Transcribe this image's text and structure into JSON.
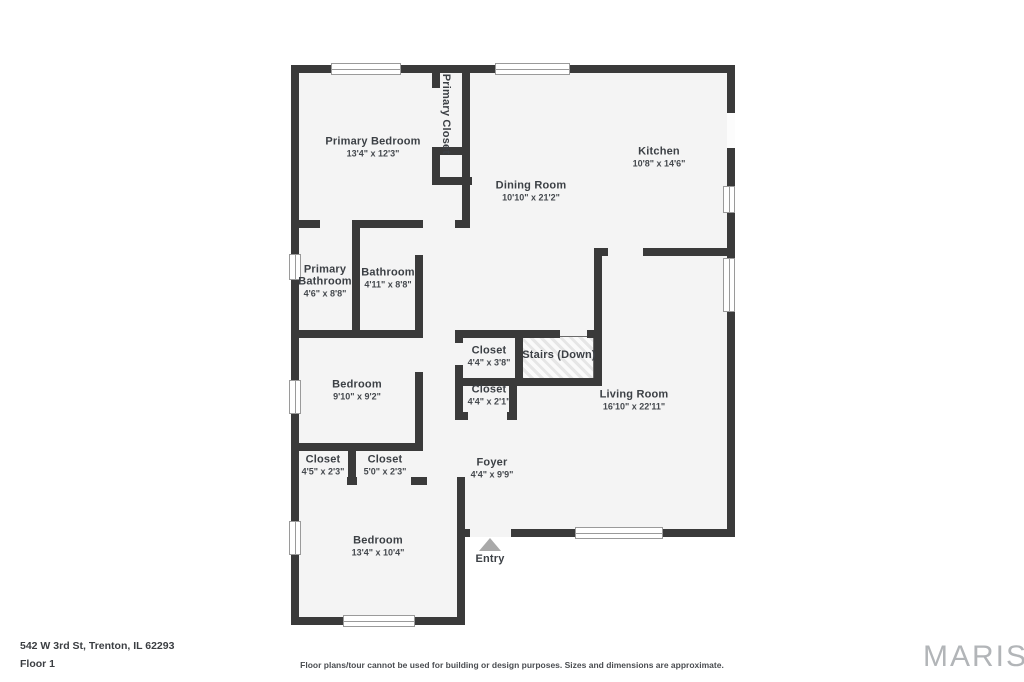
{
  "page": {
    "address": "542 W 3rd St, Trenton, IL 62293",
    "floor_label": "Floor 1",
    "disclaimer": "Floor plans/tour cannot be used for building or design purposes. Sizes and dimensions are approximate.",
    "brand": "MARIS"
  },
  "colors": {
    "wall": "#3a3a3a",
    "floor": "#f4f4f4",
    "entry_arrow": "#a9a9a9",
    "brand_gray": "#b2b5b8"
  },
  "rooms": [
    {
      "name": "Primary Bedroom",
      "dims": "13'4\" x 12'3\""
    },
    {
      "name": "Primary Closet",
      "dims": ""
    },
    {
      "name": "Kitchen",
      "dims": "10'8\" x 14'6\""
    },
    {
      "name": "Dining Room",
      "dims": "10'10\" x 21'2\""
    },
    {
      "name": "Primary Bathroom",
      "dims": "4'6\" x 8'8\""
    },
    {
      "name": "Bathroom",
      "dims": "4'11\" x 8'8\""
    },
    {
      "name": "Closet",
      "dims": "4'4\" x 3'8\""
    },
    {
      "name": "Stairs (Down)",
      "dims": ""
    },
    {
      "name": "Closet",
      "dims": "4'4\" x 2'1\""
    },
    {
      "name": "Bedroom",
      "dims": "9'10\" x 9'2\""
    },
    {
      "name": "Living Room",
      "dims": "16'10\" x 22'11\""
    },
    {
      "name": "Closet",
      "dims": "4'5\" x 2'3\""
    },
    {
      "name": "Closet",
      "dims": "5'0\" x 2'3\""
    },
    {
      "name": "Foyer",
      "dims": "4'4\" x 9'9\""
    },
    {
      "name": "Bedroom",
      "dims": "13'4\" x 10'4\""
    },
    {
      "name": "Entry",
      "dims": ""
    }
  ]
}
